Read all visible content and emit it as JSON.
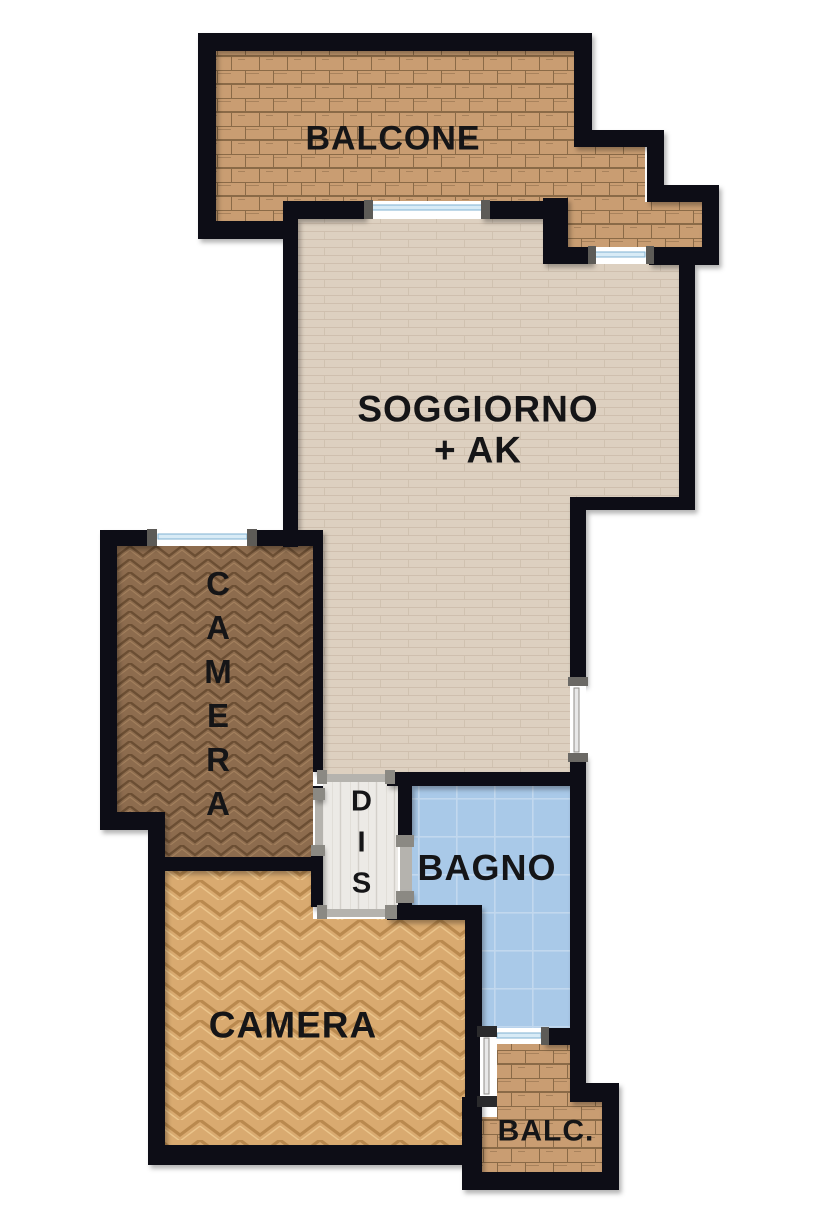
{
  "plan_title": "apartment-floor-plan",
  "rooms": {
    "balcone": {
      "label": "BALCONE"
    },
    "soggiorno": {
      "label": "SOGGIORNO",
      "sublabel": "+ AK"
    },
    "camera1": {
      "label": "CAMERA",
      "orientation": "vertical"
    },
    "dis": {
      "label": "DIS",
      "orientation": "vertical"
    },
    "bagno": {
      "label": "BAGNO"
    },
    "camera2": {
      "label": "CAMERA"
    },
    "balc": {
      "label": "BALC."
    }
  },
  "colors": {
    "background": "#ffffff",
    "wall": "#111114",
    "label_text": "#151517",
    "balcony_floor": "#c99d72",
    "balcony_joint": "#8a6a47",
    "soggiorno_floor": "#ddd0c0",
    "soggiorno_joint": "#cdbeac",
    "camera1_floor": "#8d6c4e",
    "camera1_joint": "#6b4e33",
    "camera2_floor": "#d9aa70",
    "camera2_joint": "#b9894e",
    "dis_floor": "#eceae6",
    "dis_joint": "#d3d0ca",
    "bagno_floor": "#a9c9e8",
    "bagno_joint": "#c2d8ee",
    "window_glass": "#d8ebf6",
    "window_frame": "#7fb2d2",
    "window_cap": "#5d5b57",
    "door_threshold": "#b5b3ae",
    "door_jamb": "#8b8983"
  }
}
